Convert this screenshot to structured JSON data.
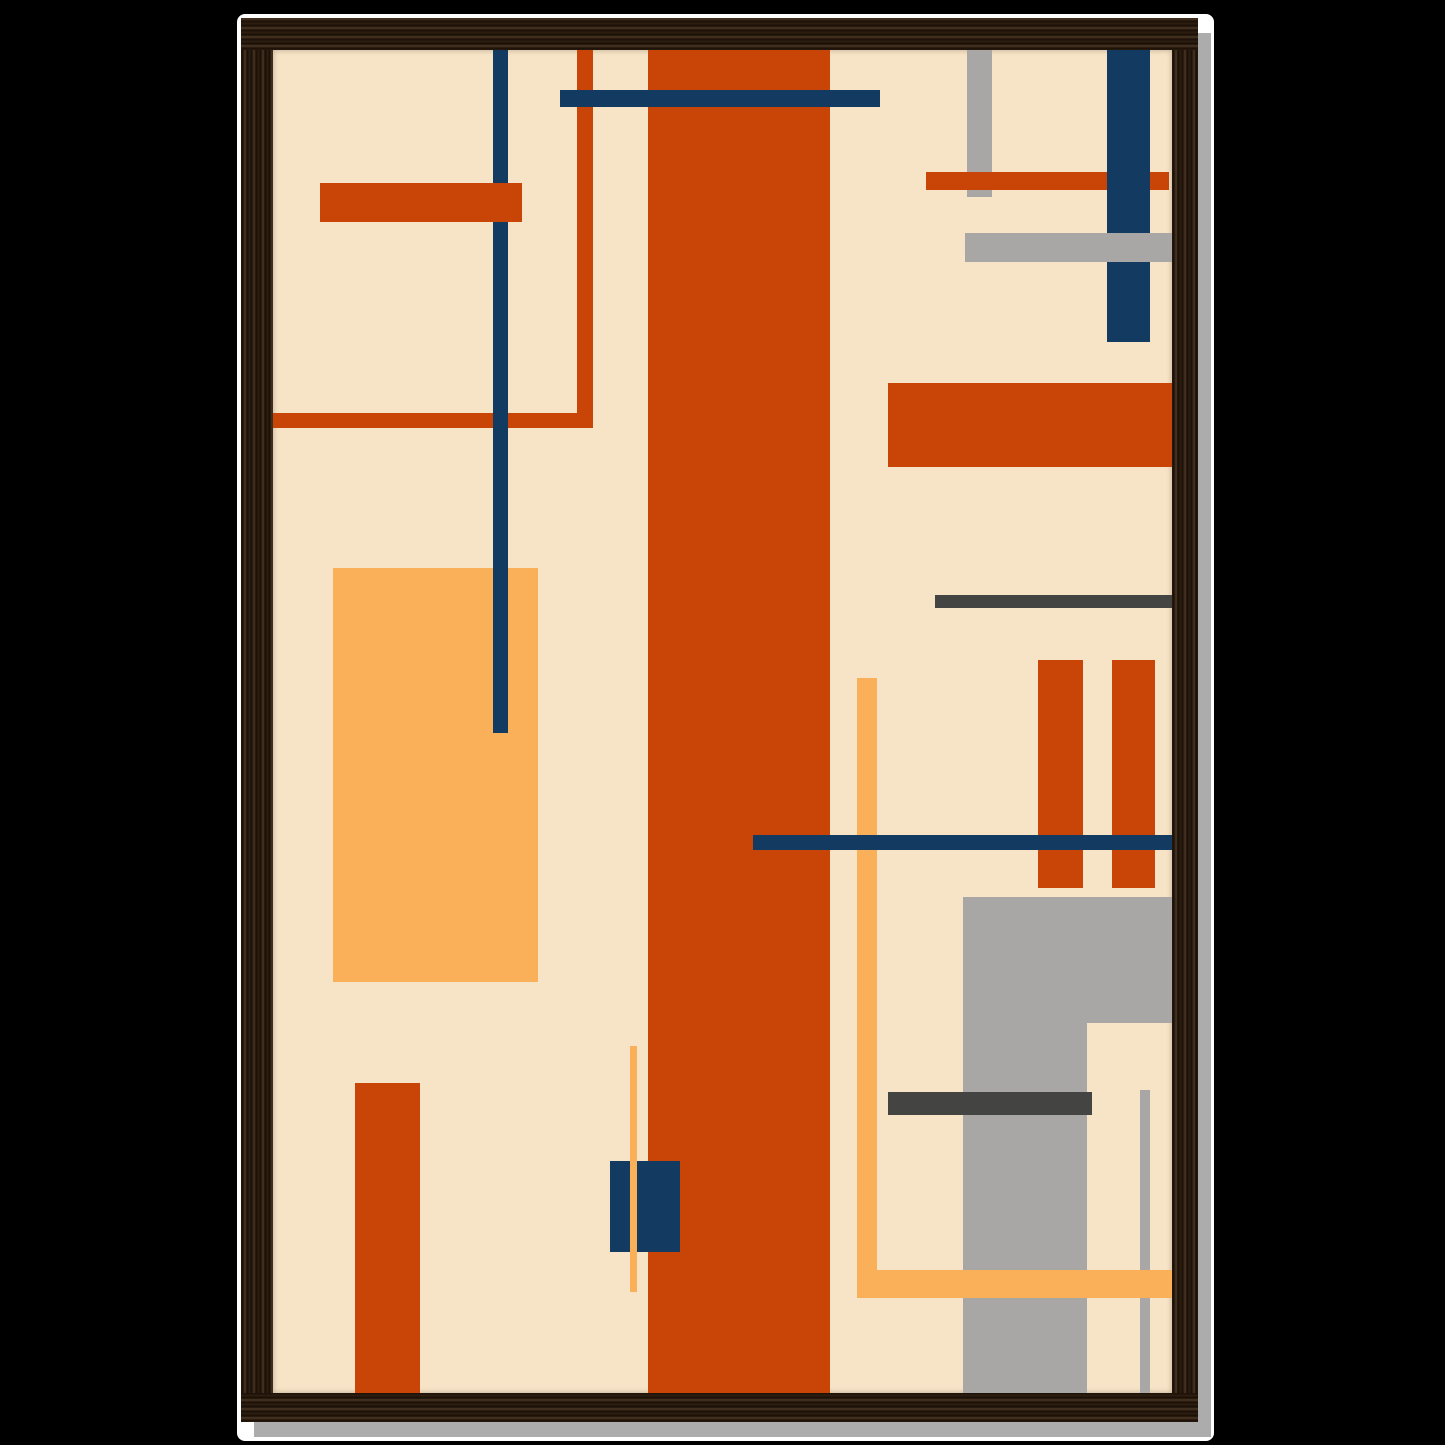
{
  "scene": {
    "type": "product-photo",
    "subject": "Abstract geometric mid-century style art print in a dark walnut wood frame with drop shadow",
    "background_color": "#000000"
  },
  "frame": {
    "wood_color": "#2F2013",
    "wood_grain_dark": "#190E05",
    "wood_grain_light": "#4E3A26",
    "mat_color": "#FFFFFF",
    "shadow_color": "#ACACAC"
  },
  "artwork": {
    "background_color": "#F7E3C5",
    "palette": {
      "orange": "#C94507",
      "navy": "#133A60",
      "amber": "#F9B058",
      "gray": "#A9A6A6",
      "dark_gray": "#444442",
      "cream": "#F7E3C5"
    },
    "canvas": {
      "width": 899,
      "height": 1343
    },
    "shapes": [
      {
        "name": "amber-rect-left",
        "color": "amber",
        "x": 60,
        "y": 518,
        "w": 205,
        "h": 414
      },
      {
        "name": "orange-corner-vertical",
        "color": "orange",
        "x": 304,
        "y": 0,
        "w": 16,
        "h": 378
      },
      {
        "name": "orange-corner-horizontal",
        "color": "orange",
        "x": 0,
        "y": 363,
        "w": 315,
        "h": 15
      },
      {
        "name": "navy-vertical-left",
        "color": "navy",
        "x": 220,
        "y": 0,
        "w": 15,
        "h": 683
      },
      {
        "name": "orange-bar-topleft",
        "color": "orange",
        "x": 47,
        "y": 133,
        "w": 202,
        "h": 39
      },
      {
        "name": "orange-column-center",
        "color": "orange",
        "x": 375,
        "y": 0,
        "w": 182,
        "h": 1343
      },
      {
        "name": "navy-bar-top",
        "color": "navy",
        "x": 287,
        "y": 40,
        "w": 320,
        "h": 17
      },
      {
        "name": "gray-vertical-topright",
        "color": "gray",
        "x": 694,
        "y": 0,
        "w": 25,
        "h": 147
      },
      {
        "name": "orange-bar-topright",
        "color": "orange",
        "x": 653,
        "y": 122,
        "w": 243,
        "h": 18
      },
      {
        "name": "navy-wide-vertical-topright",
        "color": "navy",
        "x": 834,
        "y": 0,
        "w": 43,
        "h": 292
      },
      {
        "name": "gray-bar-topright",
        "color": "gray",
        "x": 692,
        "y": 183,
        "w": 207,
        "h": 29
      },
      {
        "name": "orange-rect-right",
        "color": "orange",
        "x": 615,
        "y": 333,
        "w": 284,
        "h": 84
      },
      {
        "name": "darkgray-line-right",
        "color": "dark_gray",
        "x": 662,
        "y": 545,
        "w": 237,
        "h": 13
      },
      {
        "name": "orange-pillar-left",
        "color": "orange",
        "x": 765,
        "y": 610,
        "w": 45,
        "h": 228
      },
      {
        "name": "orange-pillar-right",
        "color": "orange",
        "x": 839,
        "y": 610,
        "w": 43,
        "h": 228
      },
      {
        "name": "amber-line-vertical-mid",
        "color": "amber",
        "x": 584,
        "y": 628,
        "w": 20,
        "h": 620
      },
      {
        "name": "navy-line-middle",
        "color": "navy",
        "x": 480,
        "y": 785,
        "w": 419,
        "h": 15
      },
      {
        "name": "gray-rect-bottomright-top",
        "color": "gray",
        "x": 690,
        "y": 847,
        "w": 209,
        "h": 126
      },
      {
        "name": "gray-column-bottomright",
        "color": "gray",
        "x": 690,
        "y": 847,
        "w": 124,
        "h": 496
      },
      {
        "name": "darkgray-bar-bottom",
        "color": "dark_gray",
        "x": 615,
        "y": 1042,
        "w": 204,
        "h": 23
      },
      {
        "name": "gray-thin-vertical-bottom",
        "color": "gray",
        "x": 867,
        "y": 1040,
        "w": 10,
        "h": 303
      },
      {
        "name": "amber-bar-bottom",
        "color": "amber",
        "x": 584,
        "y": 1220,
        "w": 315,
        "h": 28
      },
      {
        "name": "navy-square-bottom",
        "color": "navy",
        "x": 337,
        "y": 1111,
        "w": 70,
        "h": 91
      },
      {
        "name": "amber-thin-line-bottom",
        "color": "amber",
        "x": 357,
        "y": 996,
        "w": 7,
        "h": 246
      },
      {
        "name": "orange-rect-bottomleft",
        "color": "orange",
        "x": 82,
        "y": 1033,
        "w": 65,
        "h": 310
      }
    ]
  }
}
